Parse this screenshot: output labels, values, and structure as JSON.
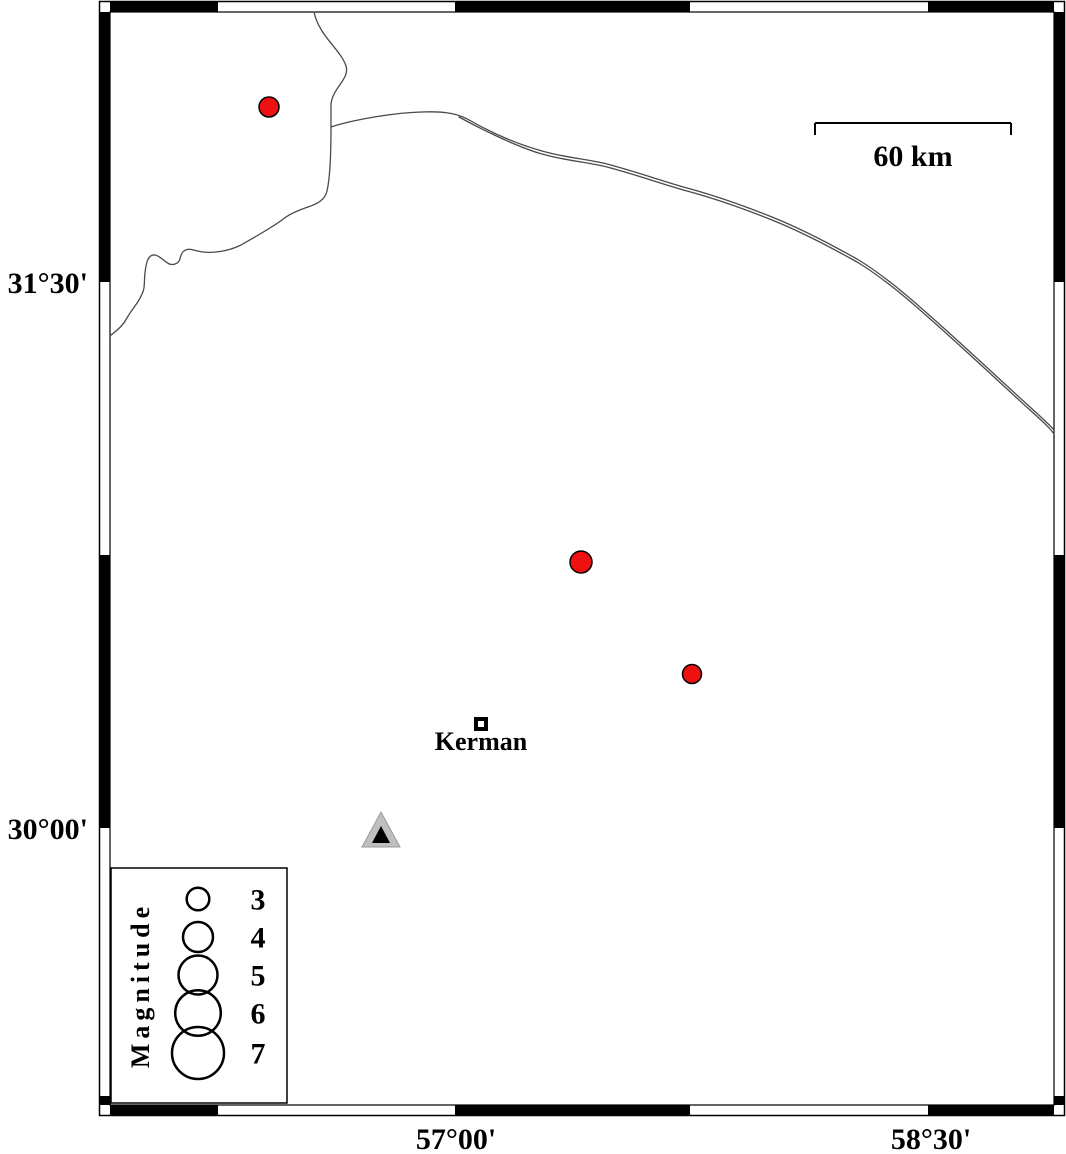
{
  "figure": {
    "type": "seismicity-map",
    "axis": {
      "left": [
        {
          "text": "31°30'"
        },
        {
          "text": "30°00'"
        }
      ],
      "bottom": [
        {
          "text": "57°00'"
        },
        {
          "text": "58°30'"
        }
      ]
    },
    "scale_bar": {
      "label": "60 km",
      "length_km": 60
    },
    "city": {
      "name": "Kerman",
      "x": 481,
      "y": 724
    },
    "station": {
      "x": 381,
      "y": 830
    },
    "earthquakes": [
      {
        "x": 269,
        "y": 107,
        "r": 10
      },
      {
        "x": 581,
        "y": 562,
        "r": 11
      },
      {
        "x": 692,
        "y": 674,
        "r": 9.5
      }
    ],
    "legend": {
      "title": "Magnitude",
      "entries": [
        {
          "label": "3",
          "r": 11.3
        },
        {
          "label": "4",
          "r": 15
        },
        {
          "label": "5",
          "r": 19.5
        },
        {
          "label": "6",
          "r": 22.8
        },
        {
          "label": "7",
          "r": 26
        }
      ]
    },
    "roads": [
      {
        "d": "M 314 12 C 319 36 341 50 346 66 C 350 79 333 87 331 104 L 331 127 C 331 152 330 178 327 191 C 325 200 317 204 308 207 C 299 210 289 214 282 220 C 268 230 253 238 241 245 C 227 252 212 253 203 252 C 194 251 189 247 184 251 C 179 254 182 262 175 264 C 167 267 162 256 155 255 C 148 254 146 263 145 273 C 144 282 145 289 142 294 C 138 304 131 310 127 318 C 122 327 117 330 110 336"
      },
      {
        "d": "M 331 127 C 352 120 392 113 421 112 C 447 111 459 114 471 121 C 492 133 517 144 542 151 C 567 158 587 159 607 164 C 634 171 662 181 687 188 C 713 195 742 205 772 217 C 802 229 832 245 857 259 C 887 277 917 304 947 331 C 977 358 1009 388 1030 407 C 1042 418 1050 425 1054 430"
      },
      {
        "d": "M 459 117 C 479 128 517 147 542 154 C 567 161 587 162 607 167 C 634 174 662 184 687 191 C 713 198 742 208 772 220 C 802 232 832 248 857 262 C 887 280 917 307 947 334 C 977 361 1009 391 1030 410 C 1042 421 1050 428 1054 434"
      }
    ],
    "colors": {
      "earthquake_fill": "#ee1111",
      "marker_stroke": "#000000",
      "station_fill": "#bfbfbf",
      "station_core": "#000000",
      "road_line": "#4a4a4a"
    }
  }
}
